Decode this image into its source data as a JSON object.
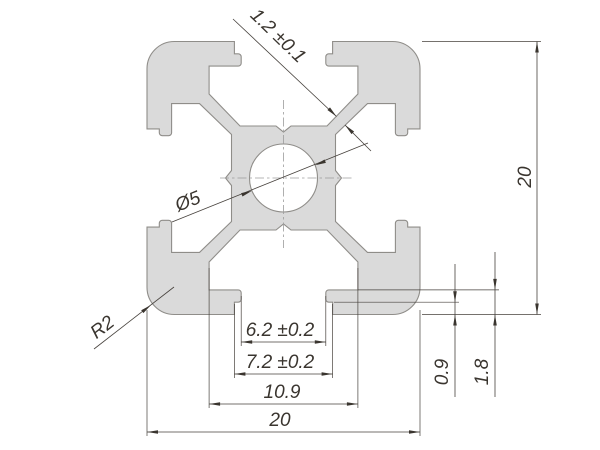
{
  "drawing": {
    "type": "technical-cross-section",
    "subject": "20x20 aluminium T-slot extrusion profile",
    "labels": {
      "web_thickness": "1.2 ±0.1",
      "hole_diameter": "Ø5",
      "corner_radius": "R2",
      "slot_opening": "6.2 ±0.2",
      "slot_step": "7.2 ±0.2",
      "slot_cavity": "10.9",
      "overall_width": "20",
      "overall_height": "20",
      "lip_step": "0.9",
      "lip_height": "1.8"
    },
    "colors": {
      "profile_fill": "#dadada",
      "profile_stroke": "#8f8d89",
      "dimension_lines": "#47423d",
      "text": "#3a352f",
      "centerline": "#9c9c9c",
      "background": "#ffffff"
    }
  }
}
